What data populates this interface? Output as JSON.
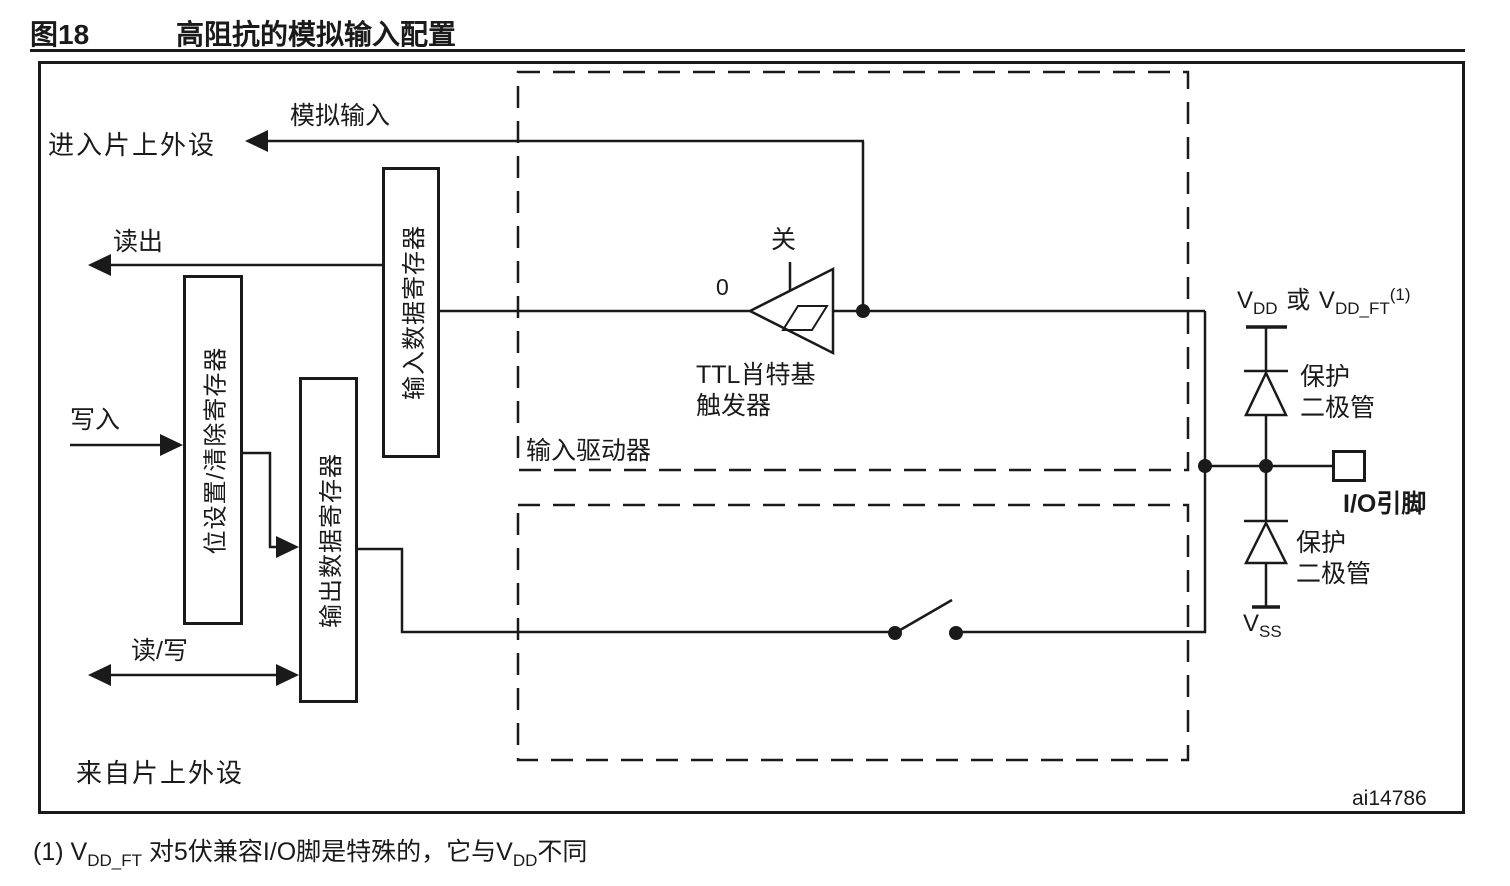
{
  "figure": {
    "number": "图18",
    "title": "高阻抗的模拟输入配置",
    "watermark": "ai14786"
  },
  "labels": {
    "analog_input": "模拟输入",
    "to_on_chip_peripheral": "进入片上外设",
    "read": "读出",
    "write": "写入",
    "read_write": "读/写",
    "from_on_chip_peripheral": "来自片上外设",
    "input_driver": "输入驱动器",
    "schmitt_line1": "TTL肖特基",
    "schmitt_line2": "触发器",
    "off": "关",
    "zero": "0",
    "io_pin": "I/O引脚",
    "protection_line1": "保护",
    "protection_line2": "二极管"
  },
  "registers": {
    "input_data": "输入数据寄存器",
    "bit_set_clear": "位设置/清除寄存器",
    "output_data": "输出数据寄存器"
  },
  "power": {
    "v": "V",
    "dd": "DD",
    "or": "或",
    "dd_ft": "DD_FT",
    "note_ref": "(1)",
    "ss": "SS"
  },
  "footnote": {
    "p1": "(1) V",
    "sub1": "DD_FT",
    "p2": " 对5伏兼容I/O脚是特殊的，它与V",
    "sub2": "DD",
    "p3": "不同"
  },
  "colors": {
    "line": "#1a1a1a",
    "background": "#ffffff"
  }
}
